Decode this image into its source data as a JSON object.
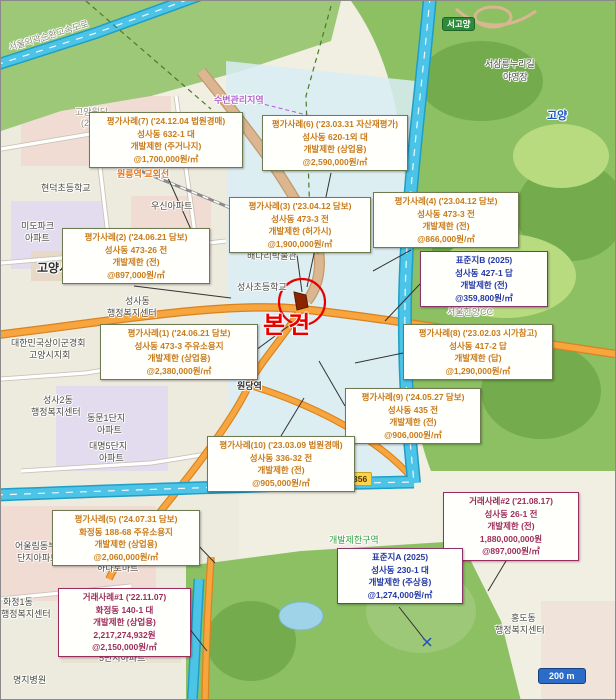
{
  "subject": {
    "label": "본건"
  },
  "scalebar": {
    "label": "200 m"
  },
  "colors": {
    "eval_border": "#6e7a50",
    "eval_text": "#c97a1a",
    "standard_border": "#8b3468",
    "standard_text": "#2438a6",
    "transaction_border": "#9b2d5c",
    "transaction_text": "#9b2d5c",
    "subject_red": "#e80000",
    "highway_cyan": "#4cc4e8",
    "road_orange": "#f7a53f",
    "forest_green": "#8cc063"
  },
  "badges": [
    {
      "id": "badge-seogoyang",
      "label": "서고양",
      "type": "green",
      "x": 441,
      "y": 16
    },
    {
      "id": "badge-route-356",
      "label": "356",
      "type": "yellow",
      "x": 347,
      "y": 471
    }
  ],
  "callouts": [
    {
      "id": "callout-eval-7",
      "type": "eval",
      "x": 88,
      "y": 111,
      "w": 148,
      "lines": [
        "평가사례(7) ('24.12.04 법원경매)",
        "성사동 632-1 대",
        "개발제한 (주거나지)",
        "@1,700,000원/㎡"
      ]
    },
    {
      "id": "callout-eval-6",
      "type": "eval",
      "x": 261,
      "y": 114,
      "w": 140,
      "lines": [
        "평가사례(6) ('23.03.31 자산재평가)",
        "성사동 620-1외 대",
        "개발제한 (상업용)",
        "@2,590,000원/㎡"
      ]
    },
    {
      "id": "callout-eval-3",
      "type": "eval",
      "x": 228,
      "y": 196,
      "w": 136,
      "lines": [
        "평가사례(3) ('23.04.12 담보)",
        "성사동 473-3 전",
        "개발제한 (허가시)",
        "@1,900,000원/㎡"
      ]
    },
    {
      "id": "callout-eval-4",
      "type": "eval",
      "x": 372,
      "y": 191,
      "w": 140,
      "lines": [
        "평가사례(4) ('23.04.12 담보)",
        "성사동 473-3 전",
        "개발제한 (전)",
        "@866,000원/㎡"
      ]
    },
    {
      "id": "callout-eval-2",
      "type": "eval",
      "x": 61,
      "y": 227,
      "w": 142,
      "lines": [
        "평가사례(2) ('24.06.21 담보)",
        "성사동 473-26 전",
        "개발제한 (전)",
        "@897,000원/㎡"
      ]
    },
    {
      "id": "callout-standard-b",
      "type": "standard",
      "x": 419,
      "y": 250,
      "w": 122,
      "lines": [
        "표준지B (2025)",
        "성사동 427-1 답",
        "개발제한 (전)",
        "@359,800원/㎡"
      ]
    },
    {
      "id": "callout-eval-1",
      "type": "eval",
      "x": 99,
      "y": 323,
      "w": 152,
      "lines": [
        "평가사례(1) ('24.06.21 담보)",
        "성사동 473-3 주유소용지",
        "개발제한 (상업용)",
        "@2,380,000원/㎡"
      ]
    },
    {
      "id": "callout-eval-8",
      "type": "eval",
      "x": 402,
      "y": 323,
      "w": 144,
      "lines": [
        "평가사례(8) ('23.02.03 시가참고)",
        "성사동 417-2 답",
        "개발제한 (답)",
        "@1,290,000원/㎡"
      ]
    },
    {
      "id": "callout-eval-9",
      "type": "eval",
      "x": 344,
      "y": 387,
      "w": 130,
      "lines": [
        "평가사례(9) ('24.05.27 담보)",
        "성사동 435 전",
        "개발제한 (전)",
        "@906,000원/㎡"
      ]
    },
    {
      "id": "callout-eval-10",
      "type": "eval",
      "x": 206,
      "y": 435,
      "w": 142,
      "lines": [
        "평가사례(10) ('23.03.09 법원경매)",
        "성사동 336-32 전",
        "개발제한 (전)",
        "@905,000원/㎡"
      ]
    },
    {
      "id": "callout-eval-5",
      "type": "eval",
      "x": 51,
      "y": 509,
      "w": 142,
      "lines": [
        "평가사례(5) ('24.07.31 담보)",
        "화정동 188-68 주유소용지",
        "개발제한 (상업용)",
        "@2,060,000원/㎡"
      ]
    },
    {
      "id": "callout-transaction-2",
      "type": "transaction",
      "x": 442,
      "y": 491,
      "w": 130,
      "lines": [
        "거래사례#2 ('21.08.17)",
        "성사동 26-1 전",
        "개발제한 (전)",
        "1,880,000,000원",
        "@897,000원/㎡"
      ]
    },
    {
      "id": "callout-standard-a",
      "type": "standard",
      "x": 336,
      "y": 547,
      "w": 120,
      "lines": [
        "표준지A (2025)",
        "성사동 230-1 대",
        "개발제한 (주상용)",
        "@1,274,000원/㎡"
      ]
    },
    {
      "id": "callout-transaction-1",
      "type": "transaction",
      "x": 57,
      "y": 587,
      "w": 127,
      "lines": [
        "거래사례#1 ('22.11.07)",
        "화정동 140-1 대",
        "개발제한 (상업용)",
        "2,217,274,932원",
        "@2,150,000원/㎡"
      ]
    }
  ],
  "labels": [
    {
      "t": "서울외곽순환고속도로",
      "x": 6,
      "y": 40,
      "c": "gray",
      "rot": -17
    },
    {
      "t": "수변관리지역",
      "x": 213,
      "y": 92,
      "c": "purple"
    },
    {
      "t": "고양원당",
      "x": 74,
      "y": 104,
      "c": "gray"
    },
    {
      "t": "(2027)",
      "x": 80,
      "y": 117,
      "c": "gray"
    },
    {
      "t": "서삼릉누리길",
      "x": 484,
      "y": 56,
      "c": "dark"
    },
    {
      "t": "야영장",
      "x": 502,
      "y": 69,
      "c": "dark"
    },
    {
      "t": "고양",
      "x": 546,
      "y": 106,
      "c": "blue"
    },
    {
      "t": "원릉역 교외선",
      "x": 116,
      "y": 166,
      "c": "orange"
    },
    {
      "t": "현덕초등학교",
      "x": 40,
      "y": 180,
      "c": "dark"
    },
    {
      "t": "우신아파트",
      "x": 150,
      "y": 198,
      "c": "dark"
    },
    {
      "t": "미도파크",
      "x": 20,
      "y": 218,
      "c": "dark"
    },
    {
      "t": "아파트",
      "x": 24,
      "y": 230,
      "c": "dark"
    },
    {
      "t": "고양시청",
      "x": 36,
      "y": 258,
      "c": "city"
    },
    {
      "t": "성사동",
      "x": 124,
      "y": 293,
      "c": "dark"
    },
    {
      "t": "행정복지센터",
      "x": 106,
      "y": 305,
      "c": "dark"
    },
    {
      "t": "배다리박물관",
      "x": 246,
      "y": 248,
      "c": "dark"
    },
    {
      "t": "성사초등학교",
      "x": 236,
      "y": 279,
      "c": "dark"
    },
    {
      "t": "대한민국상이군경회",
      "x": 10,
      "y": 335,
      "c": "dark"
    },
    {
      "t": "고양시지회",
      "x": 28,
      "y": 347,
      "c": "dark"
    },
    {
      "t": "원당역",
      "x": 236,
      "y": 378,
      "c": "station"
    },
    {
      "t": "자연",
      "x": 352,
      "y": 390,
      "c": "green"
    },
    {
      "t": "성사2동",
      "x": 42,
      "y": 392,
      "c": "dark"
    },
    {
      "t": "행정복지센터",
      "x": 30,
      "y": 404,
      "c": "dark"
    },
    {
      "t": "동문1단지",
      "x": 86,
      "y": 410,
      "c": "dark"
    },
    {
      "t": "아파트",
      "x": 96,
      "y": 422,
      "c": "dark"
    },
    {
      "t": "대명5단지",
      "x": 88,
      "y": 438,
      "c": "dark"
    },
    {
      "t": "아파트",
      "x": 98,
      "y": 450,
      "c": "dark"
    },
    {
      "t": "서울한양CC",
      "x": 446,
      "y": 304,
      "c": "gray"
    },
    {
      "t": "개발제한구역",
      "x": 328,
      "y": 532,
      "c": "green"
    },
    {
      "t": "어울림동부",
      "x": 14,
      "y": 538,
      "c": "dark"
    },
    {
      "t": "단지아파트",
      "x": 16,
      "y": 550,
      "c": "dark"
    },
    {
      "t": "하나로마트",
      "x": 96,
      "y": 560,
      "c": "dark"
    },
    {
      "t": "화정1동",
      "x": 2,
      "y": 594,
      "c": "dark"
    },
    {
      "t": "행정복지센터",
      "x": 0,
      "y": 606,
      "c": "dark"
    },
    {
      "t": "명지병원",
      "x": 12,
      "y": 672,
      "c": "dark"
    },
    {
      "t": "5단지아파트",
      "x": 98,
      "y": 650,
      "c": "dark"
    },
    {
      "t": "홍도동",
      "x": 510,
      "y": 610,
      "c": "dark"
    },
    {
      "t": "행정복지센터",
      "x": 494,
      "y": 622,
      "c": "dark"
    }
  ]
}
